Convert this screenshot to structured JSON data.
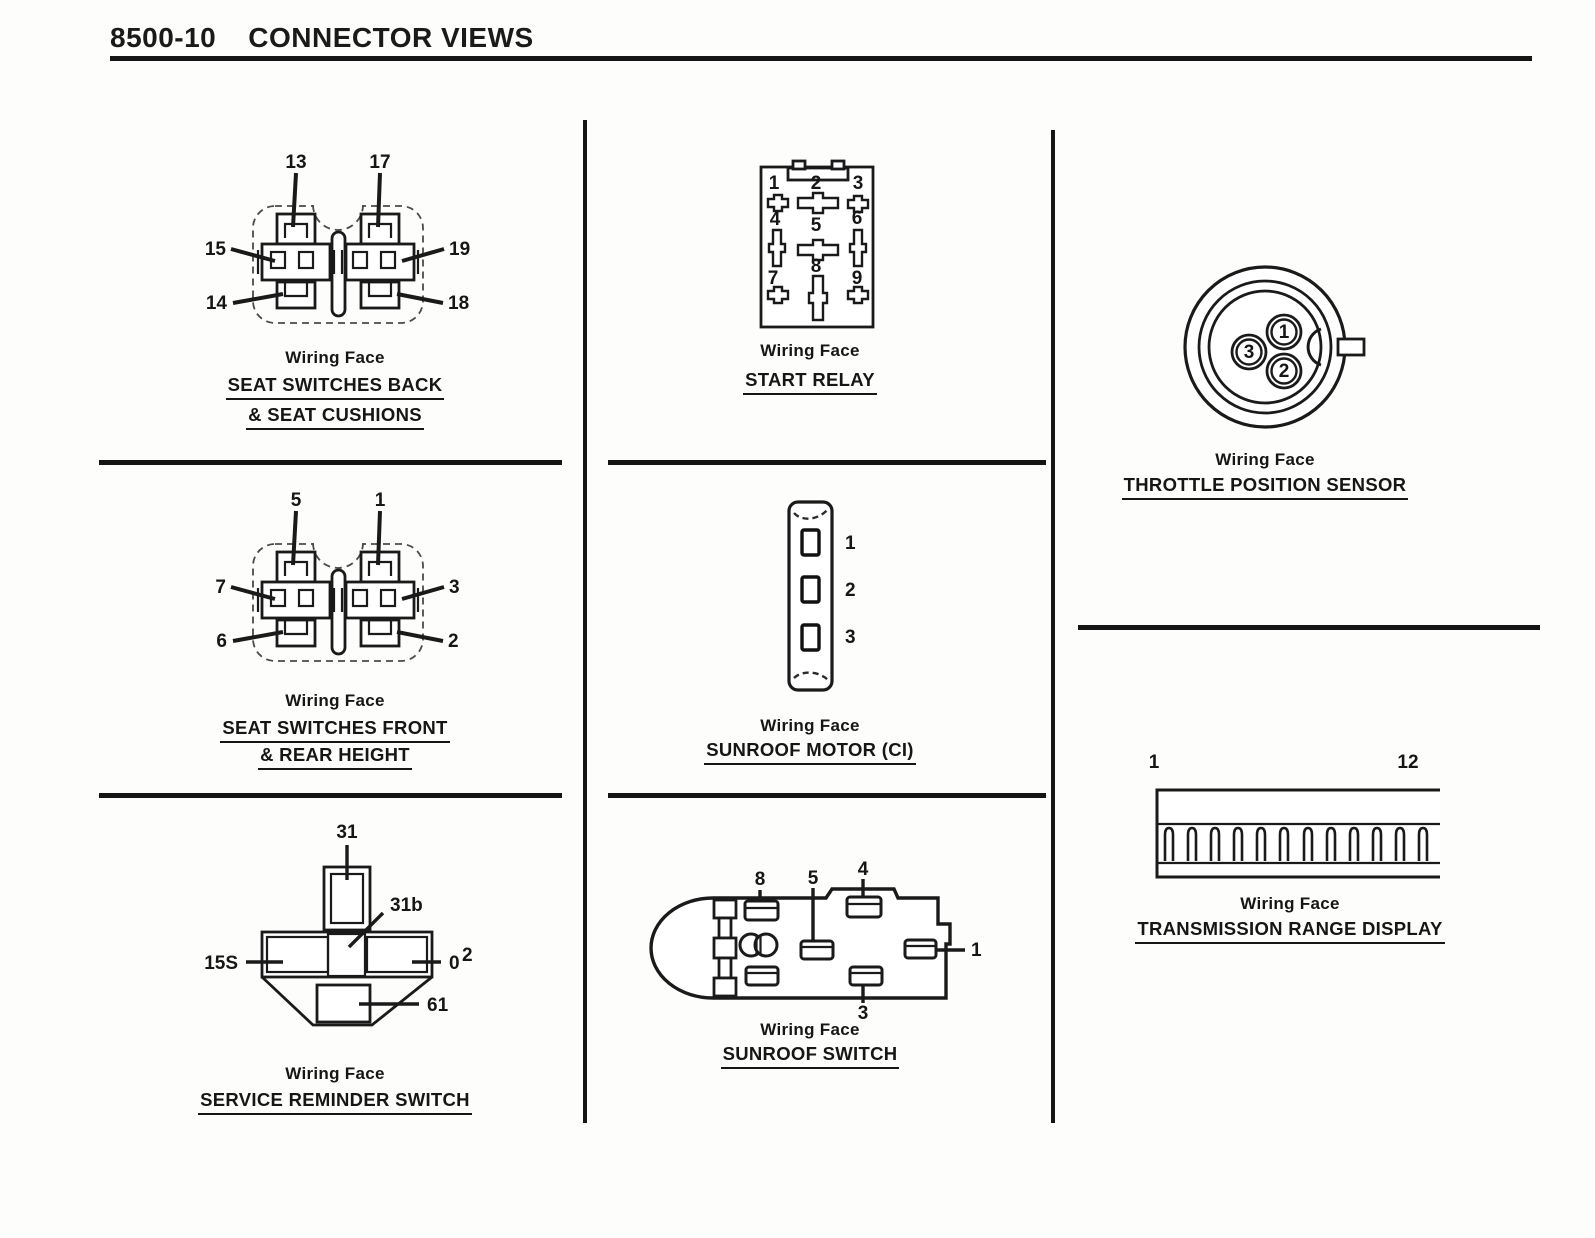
{
  "page": {
    "code": "8500-10",
    "title": "CONNECTOR VIEWS"
  },
  "colors": {
    "ink": "#1a1a1a",
    "paper": "#fdfdfb"
  },
  "panels": {
    "seat_switches_back": {
      "wiring_face": "Wiring Face",
      "title_line1": "SEAT SWITCHES BACK",
      "title_line2": "& SEAT CUSHIONS",
      "pins": {
        "top_left": "13",
        "top_right": "17",
        "mid_left": "15",
        "mid_right": "19",
        "bottom_left": "14",
        "bottom_right": "18"
      }
    },
    "seat_switches_front": {
      "wiring_face": "Wiring Face",
      "title_line1": "SEAT SWITCHES FRONT",
      "title_line2": "& REAR HEIGHT",
      "pins": {
        "top_left": "5",
        "top_right": "1",
        "mid_left": "7",
        "mid_right": "3",
        "bottom_left": "6",
        "bottom_right": "2"
      }
    },
    "service_reminder_switch": {
      "wiring_face": "Wiring Face",
      "title_line1": "SERVICE REMINDER SWITCH",
      "pins": {
        "top": "31",
        "center": "31b",
        "left": "15S",
        "right": "0",
        "right_sup": "2",
        "bottom": "61"
      }
    },
    "start_relay": {
      "wiring_face": "Wiring Face",
      "title_line1": "START RELAY",
      "pins": {
        "p1": "1",
        "p2": "2",
        "p3": "3",
        "p4": "4",
        "p5": "5",
        "p6": "6",
        "p7": "7",
        "p8": "8",
        "p9": "9"
      }
    },
    "sunroof_motor": {
      "wiring_face": "Wiring Face",
      "title_line1": "SUNROOF MOTOR (CI)",
      "pins": {
        "p1": "1",
        "p2": "2",
        "p3": "3"
      }
    },
    "sunroof_switch": {
      "wiring_face": "Wiring Face",
      "title_line1": "SUNROOF SWITCH",
      "pins": {
        "p8": "8",
        "p5": "5",
        "p4": "4",
        "p1": "1",
        "p3": "3"
      }
    },
    "throttle_position_sensor": {
      "wiring_face": "Wiring Face",
      "title_line1": "THROTTLE POSITION SENSOR",
      "pins": {
        "p1": "1",
        "p2": "2",
        "p3": "3"
      }
    },
    "transmission_range_display": {
      "wiring_face": "Wiring Face",
      "title_line1": "TRANSMISSION RANGE DISPLAY",
      "pins": {
        "first": "1",
        "last": "12"
      }
    }
  }
}
